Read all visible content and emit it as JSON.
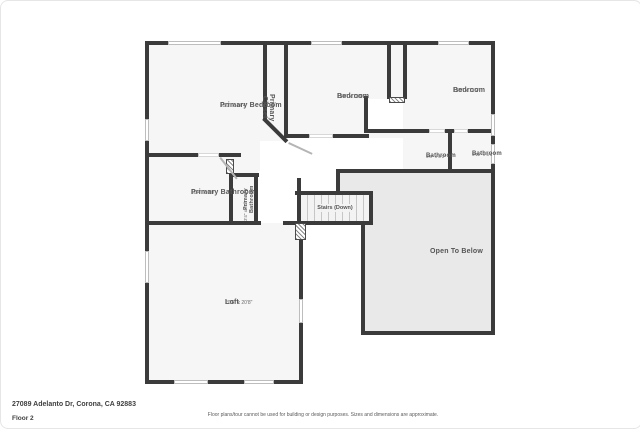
{
  "meta": {
    "address": "27089 Adelanto Dr, Corona, CA 92883",
    "floor_label": "Floor 2",
    "disclaimer": "Floor plans/tour cannot be used for building or design purposes. Sizes and dimensions are approximate."
  },
  "rooms": {
    "primary_bedroom": {
      "name": "Primary Bedroom",
      "dims": "15'1\" x 14'4\""
    },
    "primary_closet": {
      "name": "Primary Closet"
    },
    "bedroom_1": {
      "name": "Bedroom",
      "dims": "13'4\" x 13'0\""
    },
    "bedroom_2": {
      "name": "Bedroom",
      "dims": "13'9\" x 11'2\""
    },
    "bathroom_1": {
      "name": "Bathroom",
      "dims": "5'8\" x 5'1\""
    },
    "bathroom_2": {
      "name": "Bathroom",
      "dims": "5'11\" x 5'1\""
    },
    "primary_bathroom": {
      "name": "Primary Bathroom",
      "dims": "10'4\" x 9'0\""
    },
    "primary_bathroom_2": {
      "name": "Primary Bathroom",
      "dims": "3'4\" x 6'1\""
    },
    "stairs": {
      "name": "Stairs (Down)"
    },
    "open_to_below": {
      "name": "Open To Below"
    },
    "loft": {
      "name": "Loft",
      "dims": "20'6\" x 20'8\""
    }
  },
  "colors": {
    "wall": "#3b3b3b",
    "room_fill": "#f6f6f6",
    "open_area_fill": "#e9e9e9",
    "label_text": "#555555"
  }
}
